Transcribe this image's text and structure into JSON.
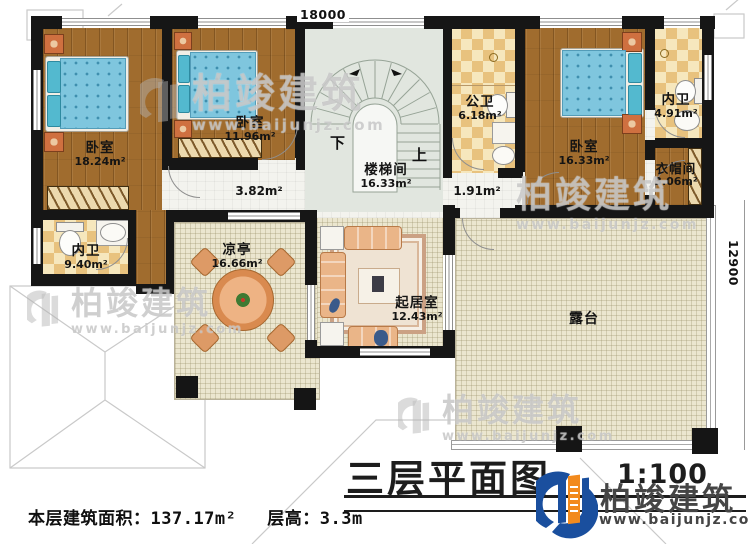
{
  "plan": {
    "title": "三层平面图",
    "scale": "1:100",
    "dimensions": {
      "top": "18000",
      "right": "12900"
    },
    "stairs": {
      "down": "下",
      "up": "上"
    },
    "rooms": [
      {
        "id": "bedroom-1",
        "name": "卧室",
        "area": "18.24m²"
      },
      {
        "id": "bedroom-2",
        "name": "卧室",
        "area": "11.96m²"
      },
      {
        "id": "stairwell",
        "name": "楼梯间",
        "area": "16.33m²"
      },
      {
        "id": "public-bath",
        "name": "公卫",
        "area": "6.18m²"
      },
      {
        "id": "bedroom-3",
        "name": "卧室",
        "area": "16.33m²"
      },
      {
        "id": "ensuite-top",
        "name": "内卫",
        "area": "4.91m²"
      },
      {
        "id": "cloakroom",
        "name": "衣帽间",
        "area": "3.06m²"
      },
      {
        "id": "ensuite-left",
        "name": "内卫",
        "area": "9.40m²"
      },
      {
        "id": "hallway",
        "name": "",
        "area": "3.82m²"
      },
      {
        "id": "hallway-2",
        "name": "",
        "area": "1.91m²"
      },
      {
        "id": "pavilion",
        "name": "凉亭",
        "area": "16.66m²"
      },
      {
        "id": "living-room",
        "name": "起居室",
        "area": "12.43m²"
      },
      {
        "id": "terrace",
        "name": "露台",
        "area": ""
      }
    ],
    "footer": {
      "area_label": "本层建筑面积：",
      "area_value": "137.17m²",
      "height_label": "层高：",
      "height_value": "3.3m"
    },
    "watermark": {
      "brand": "柏竣建筑",
      "url": "www.baijunjz.com"
    },
    "logo": {
      "brand": "柏竣建筑",
      "url": "www.baijunjz.com"
    },
    "colors": {
      "logo_blue": "#1a4f9e",
      "logo_orange": "#f28a1d",
      "wall": "#161616"
    }
  }
}
